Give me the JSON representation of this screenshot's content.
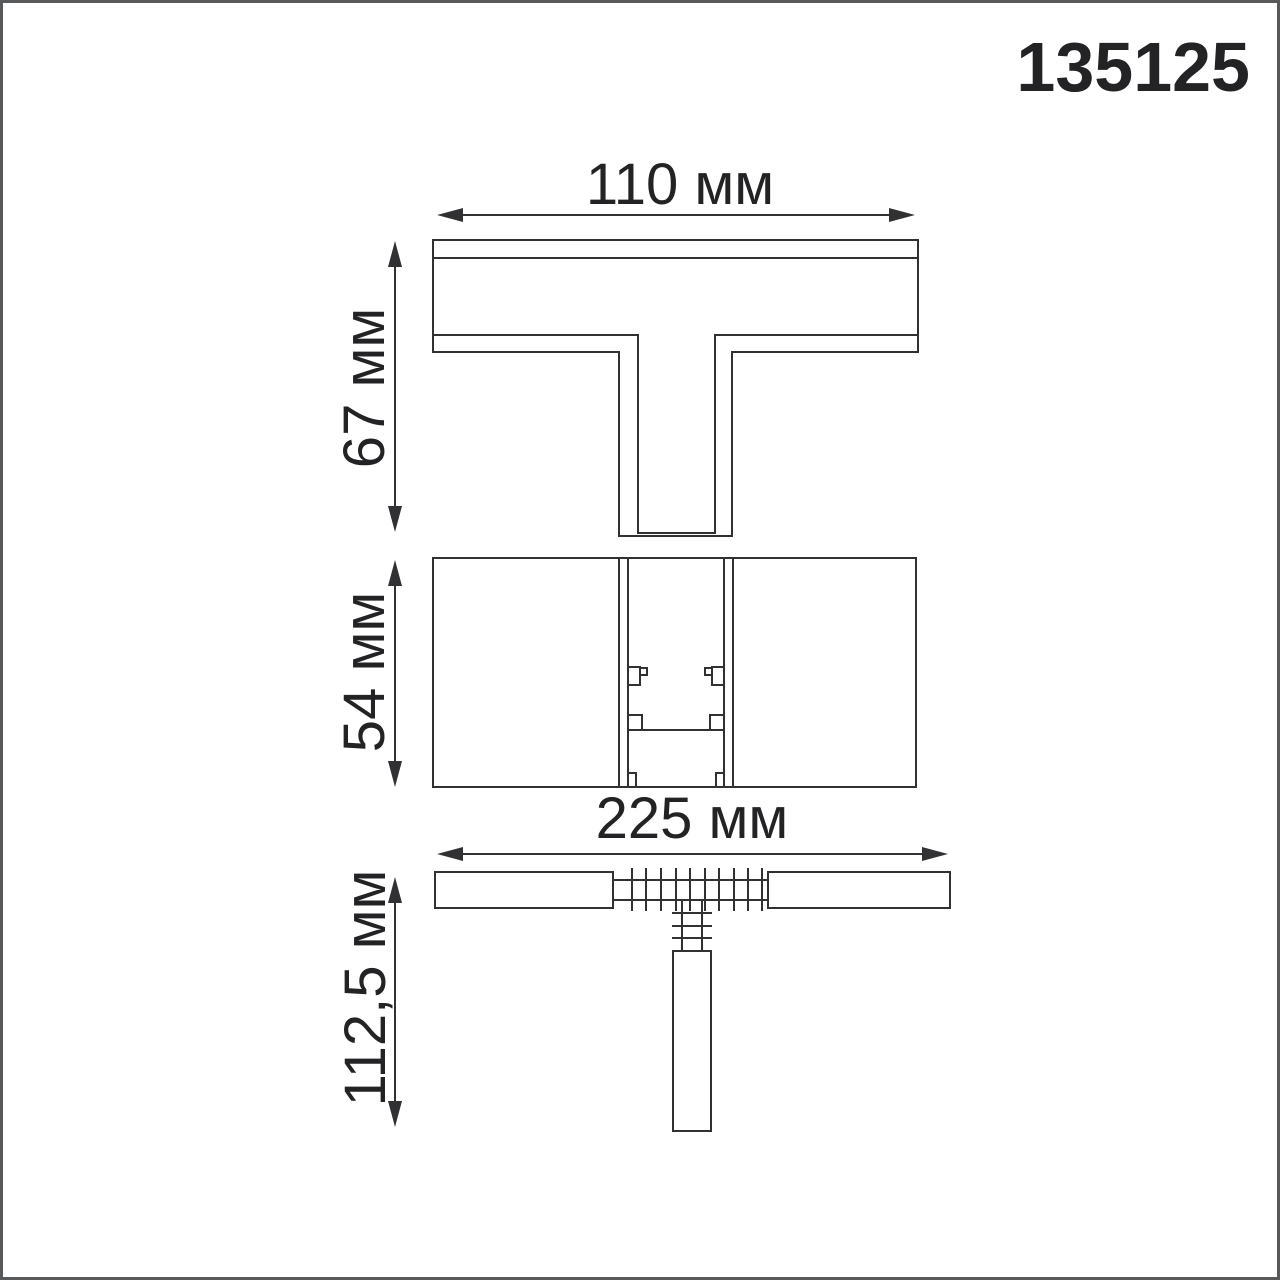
{
  "product_code": "135125",
  "unit": "мм",
  "dims": {
    "top_width": {
      "label": "110 мм",
      "value": 110
    },
    "top_height": {
      "label": "67 мм",
      "value": 67
    },
    "front_height": {
      "label": "54 мм",
      "value": 54
    },
    "plan_width": {
      "label": "225 мм",
      "value": 225
    },
    "plan_depth": {
      "label": "112,5 мм",
      "value": 112.5
    }
  },
  "colors": {
    "line": "#313133",
    "text": "#232325",
    "frame": "#58595b",
    "bg": "#ffffff"
  }
}
